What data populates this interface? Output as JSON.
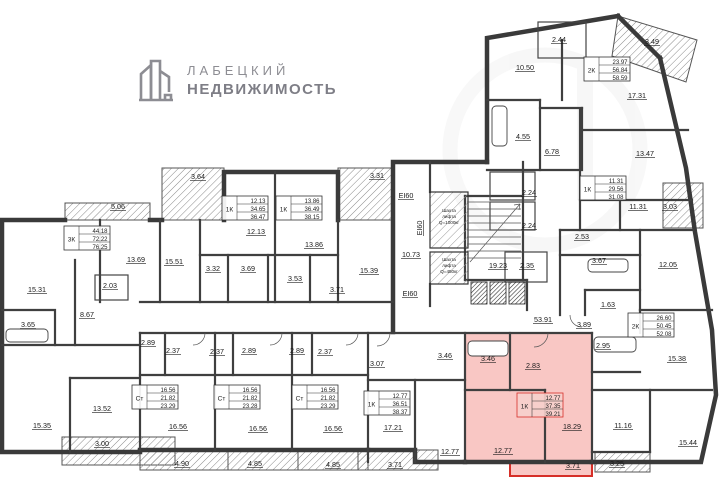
{
  "logo": {
    "name": "ЛАБЕЦКИЙ",
    "type": "НЕДВИЖИМОСТЬ"
  },
  "colors": {
    "wall": "#3a3a3a",
    "highlight_fill": "#ee5a52",
    "highlight_stroke": "#d62f28",
    "logo_gray": "#8d8d93"
  },
  "floorplan": {
    "highlighted_apartment": {
      "type": "1К",
      "values": [
        "12.77",
        "37.35",
        "39.21"
      ]
    },
    "apartments": [
      {
        "type": "3К",
        "values": [
          "44.18",
          "72.22",
          "76.25"
        ],
        "x": 64,
        "y": 226
      },
      {
        "type": "1К",
        "values": [
          "12.13",
          "34.65",
          "36.47"
        ],
        "x": 222,
        "y": 196
      },
      {
        "type": "1К",
        "values": [
          "13.86",
          "36.49",
          "38.15"
        ],
        "x": 276,
        "y": 196
      },
      {
        "type": "2К",
        "values": [
          "23.97",
          "56.84",
          "58.59"
        ],
        "x": 584,
        "y": 57
      },
      {
        "type": "1К",
        "values": [
          "11.31",
          "29.56",
          "31.08"
        ],
        "x": 580,
        "y": 176
      },
      {
        "type": "2К",
        "values": [
          "26.60",
          "50.45",
          "52.08"
        ],
        "x": 628,
        "y": 313
      },
      {
        "type": "Ст",
        "values": [
          "16.56",
          "21.82",
          "23.29"
        ],
        "x": 132,
        "y": 385
      },
      {
        "type": "Ст",
        "values": [
          "16.56",
          "21.82",
          "23.28"
        ],
        "x": 214,
        "y": 385
      },
      {
        "type": "Ст",
        "values": [
          "16.56",
          "21.82",
          "23.29"
        ],
        "x": 292,
        "y": 385
      },
      {
        "type": "1К",
        "values": [
          "12.77",
          "36.51",
          "38.37"
        ],
        "x": 364,
        "y": 391
      },
      {
        "type": "1К",
        "values": [
          "12.77",
          "37.35",
          "39.21"
        ],
        "x": 517,
        "y": 393,
        "hl": true
      }
    ],
    "area_labels": [
      {
        "t": "5.06",
        "x": 118,
        "y": 209
      },
      {
        "t": "13.69",
        "x": 136,
        "y": 262
      },
      {
        "t": "15.51",
        "x": 174,
        "y": 264
      },
      {
        "t": "2.03",
        "x": 110,
        "y": 288
      },
      {
        "t": "15.31",
        "x": 37,
        "y": 292
      },
      {
        "t": "8.67",
        "x": 87,
        "y": 317
      },
      {
        "t": "3.65",
        "x": 28,
        "y": 327
      },
      {
        "t": "3.64",
        "x": 198,
        "y": 179
      },
      {
        "t": "3.31",
        "x": 377,
        "y": 178
      },
      {
        "t": "12.13",
        "x": 256,
        "y": 234
      },
      {
        "t": "13.86",
        "x": 314,
        "y": 247
      },
      {
        "t": "3.32",
        "x": 213,
        "y": 271
      },
      {
        "t": "3.69",
        "x": 248,
        "y": 271
      },
      {
        "t": "3.53",
        "x": 295,
        "y": 281
      },
      {
        "t": "3.71",
        "x": 337,
        "y": 292
      },
      {
        "t": "15.39",
        "x": 369,
        "y": 273
      },
      {
        "t": "2.89",
        "x": 148,
        "y": 345
      },
      {
        "t": "2.37",
        "x": 173,
        "y": 353
      },
      {
        "t": "2.37",
        "x": 217,
        "y": 354
      },
      {
        "t": "2.89",
        "x": 249,
        "y": 353
      },
      {
        "t": "2.89",
        "x": 297,
        "y": 353
      },
      {
        "t": "2.37",
        "x": 325,
        "y": 354
      },
      {
        "t": "16.56",
        "x": 178,
        "y": 429
      },
      {
        "t": "16.56",
        "x": 258,
        "y": 431
      },
      {
        "t": "16.56",
        "x": 333,
        "y": 431
      },
      {
        "t": "15.35",
        "x": 42,
        "y": 428
      },
      {
        "t": "13.52",
        "x": 102,
        "y": 411
      },
      {
        "t": "3.00",
        "x": 102,
        "y": 446
      },
      {
        "t": "4.90",
        "x": 182,
        "y": 466
      },
      {
        "t": "4.85",
        "x": 255,
        "y": 466
      },
      {
        "t": "4.85",
        "x": 333,
        "y": 467
      },
      {
        "t": "3.07",
        "x": 377,
        "y": 366
      },
      {
        "t": "3.46",
        "x": 445,
        "y": 358
      },
      {
        "t": "17.21",
        "x": 393,
        "y": 430
      },
      {
        "t": "12.77",
        "x": 450,
        "y": 454
      },
      {
        "t": "3.71",
        "x": 395,
        "y": 467
      },
      {
        "t": "3.46",
        "x": 488,
        "y": 361,
        "hl": true
      },
      {
        "t": "2.83",
        "x": 533,
        "y": 368,
        "hl": true
      },
      {
        "t": "18.29",
        "x": 572,
        "y": 429,
        "hl": true
      },
      {
        "t": "12.77",
        "x": 503,
        "y": 453,
        "hl": true
      },
      {
        "t": "3.71",
        "x": 573,
        "y": 468,
        "hl": true
      },
      {
        "t": "53.91",
        "x": 543,
        "y": 322
      },
      {
        "t": "3.89",
        "x": 584,
        "y": 327
      },
      {
        "t": "2.95",
        "x": 603,
        "y": 348
      },
      {
        "t": "15.38",
        "x": 677,
        "y": 361
      },
      {
        "t": "11.16",
        "x": 623,
        "y": 428
      },
      {
        "t": "3.25",
        "x": 617,
        "y": 466
      },
      {
        "t": "15.44",
        "x": 688,
        "y": 445
      },
      {
        "t": "10.73",
        "x": 411,
        "y": 257
      },
      {
        "t": "19.23",
        "x": 498,
        "y": 268
      },
      {
        "t": "2.35",
        "x": 527,
        "y": 268
      },
      {
        "t": "2.24",
        "x": 529,
        "y": 195
      },
      {
        "t": "2.24",
        "x": 529,
        "y": 228
      },
      {
        "t": "4.55",
        "x": 523,
        "y": 139
      },
      {
        "t": "6.78",
        "x": 552,
        "y": 154
      },
      {
        "t": "10.50",
        "x": 525,
        "y": 70
      },
      {
        "t": "2.44",
        "x": 559,
        "y": 42
      },
      {
        "t": "17.31",
        "x": 637,
        "y": 98
      },
      {
        "t": "3.49",
        "x": 652,
        "y": 44
      },
      {
        "t": "13.47",
        "x": 645,
        "y": 156
      },
      {
        "t": "11.31",
        "x": 638,
        "y": 209
      },
      {
        "t": "3.03",
        "x": 670,
        "y": 209
      },
      {
        "t": "12.05",
        "x": 668,
        "y": 267
      },
      {
        "t": "2.53",
        "x": 582,
        "y": 239
      },
      {
        "t": "3.67",
        "x": 599,
        "y": 263
      },
      {
        "t": "1.63",
        "x": 608,
        "y": 307
      },
      {
        "t": "EI60",
        "x": 406,
        "y": 198
      },
      {
        "t": "EI60",
        "x": 422,
        "y": 228,
        "rot": true
      },
      {
        "t": "EI60",
        "x": 410,
        "y": 296
      }
    ],
    "shafts": [
      {
        "x": 449,
        "y": 212,
        "lines": [
          "Шахта",
          "лифта",
          "Q=1000кг"
        ]
      },
      {
        "x": 449,
        "y": 261,
        "lines": [
          "Шахта",
          "лифта",
          "Q=450кг"
        ]
      }
    ]
  }
}
